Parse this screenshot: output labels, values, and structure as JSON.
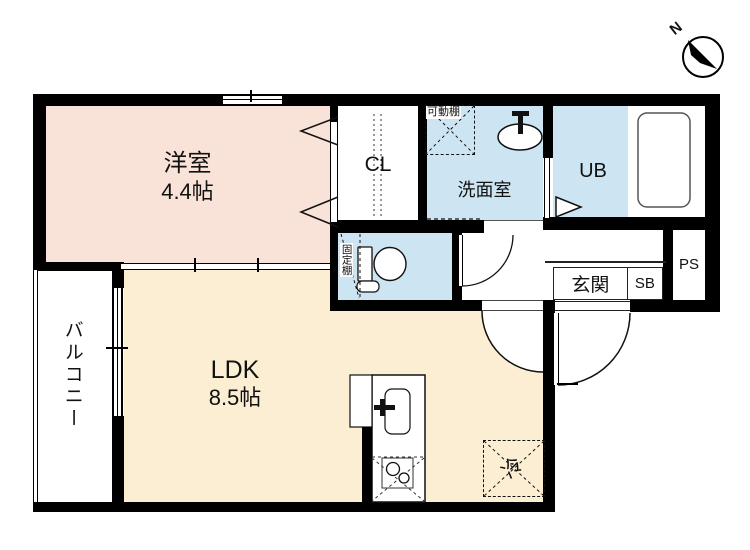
{
  "compass": {
    "north": "N"
  },
  "rooms": {
    "western_room": {
      "name": "洋室",
      "size": "4.4帖"
    },
    "ldk": {
      "name": "LDK",
      "size": "8.5帖"
    },
    "balcony": {
      "name": "バルコニー"
    },
    "closet": {
      "name": "CL"
    },
    "washroom": {
      "name": "洗面室"
    },
    "unit_bath": {
      "name": "UB"
    },
    "entrance": {
      "name": "玄関"
    },
    "shoe_box": {
      "name": "SB"
    },
    "pipe_space": {
      "name": "PS"
    }
  },
  "fixtures": {
    "movable_shelf": "可動棚",
    "fixed_shelf": "固定棚",
    "refrigerator": "冷"
  },
  "colors": {
    "wall": "#000000",
    "western_room_fill": "#f9e2d8",
    "ldk_fill": "#fbeed3",
    "wet_area_fill": "#cde4f2"
  }
}
